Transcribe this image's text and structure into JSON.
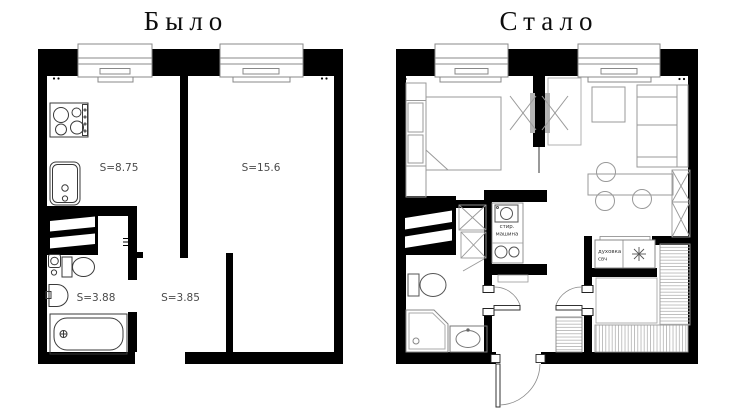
{
  "page": {
    "background_color": "#ffffff"
  },
  "colors": {
    "wall": "#000000",
    "furniture_outline": "#8f8f8f",
    "appliance_outline": "#3a3a3a",
    "label_text": "#4a4a4a",
    "title_text": "#0d0d0d"
  },
  "plan_before": {
    "title": "Было",
    "rooms": {
      "kitchen": {
        "area_label": "S=8.75"
      },
      "living_room": {
        "area_label": "S=15.6"
      },
      "bathroom": {
        "area_label": "S=3.88"
      },
      "hallway": {
        "area_label": "S=3.85"
      }
    }
  },
  "plan_after": {
    "title": "Стало",
    "appliances": {
      "washing_machine": {
        "line1": "стир.",
        "line2": "машина"
      },
      "oven": {
        "line1": "духовка",
        "line2": "свч"
      }
    }
  }
}
